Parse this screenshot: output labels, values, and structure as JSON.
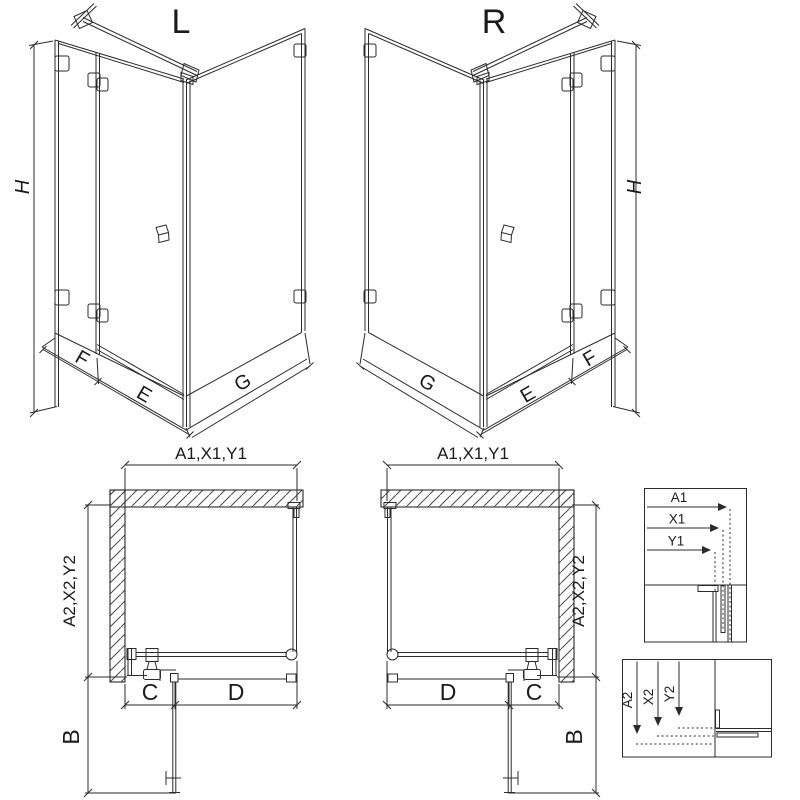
{
  "page": {
    "background": "#ffffff"
  },
  "colors": {
    "ink": "#2b2b2b",
    "dark": "#121212",
    "grey": "#9a9a9a"
  },
  "perspective_left": {
    "title": "L",
    "height": "H",
    "fixed_panel": "F",
    "door": "E",
    "side_panel": "G"
  },
  "perspective_right": {
    "title": "R",
    "height": "H",
    "fixed_panel": "F",
    "door": "E",
    "side_panel": "G"
  },
  "plan_left": {
    "width_dim": "A1,X1,Y1",
    "depth_dim": "A2,X2,Y2",
    "door_swing": "B",
    "fixed_width": "C",
    "door_width": "D"
  },
  "plan_right": {
    "width_dim": "A1,X1,Y1",
    "depth_dim": "A2,X2,Y2",
    "door_swing": "B",
    "fixed_width": "C",
    "door_width": "D"
  },
  "detail_width_box": {
    "a1": "A1",
    "x1": "X1",
    "y1": "Y1"
  },
  "detail_depth_box": {
    "a2": "A2",
    "x2": "X2",
    "y2": "Y2"
  }
}
